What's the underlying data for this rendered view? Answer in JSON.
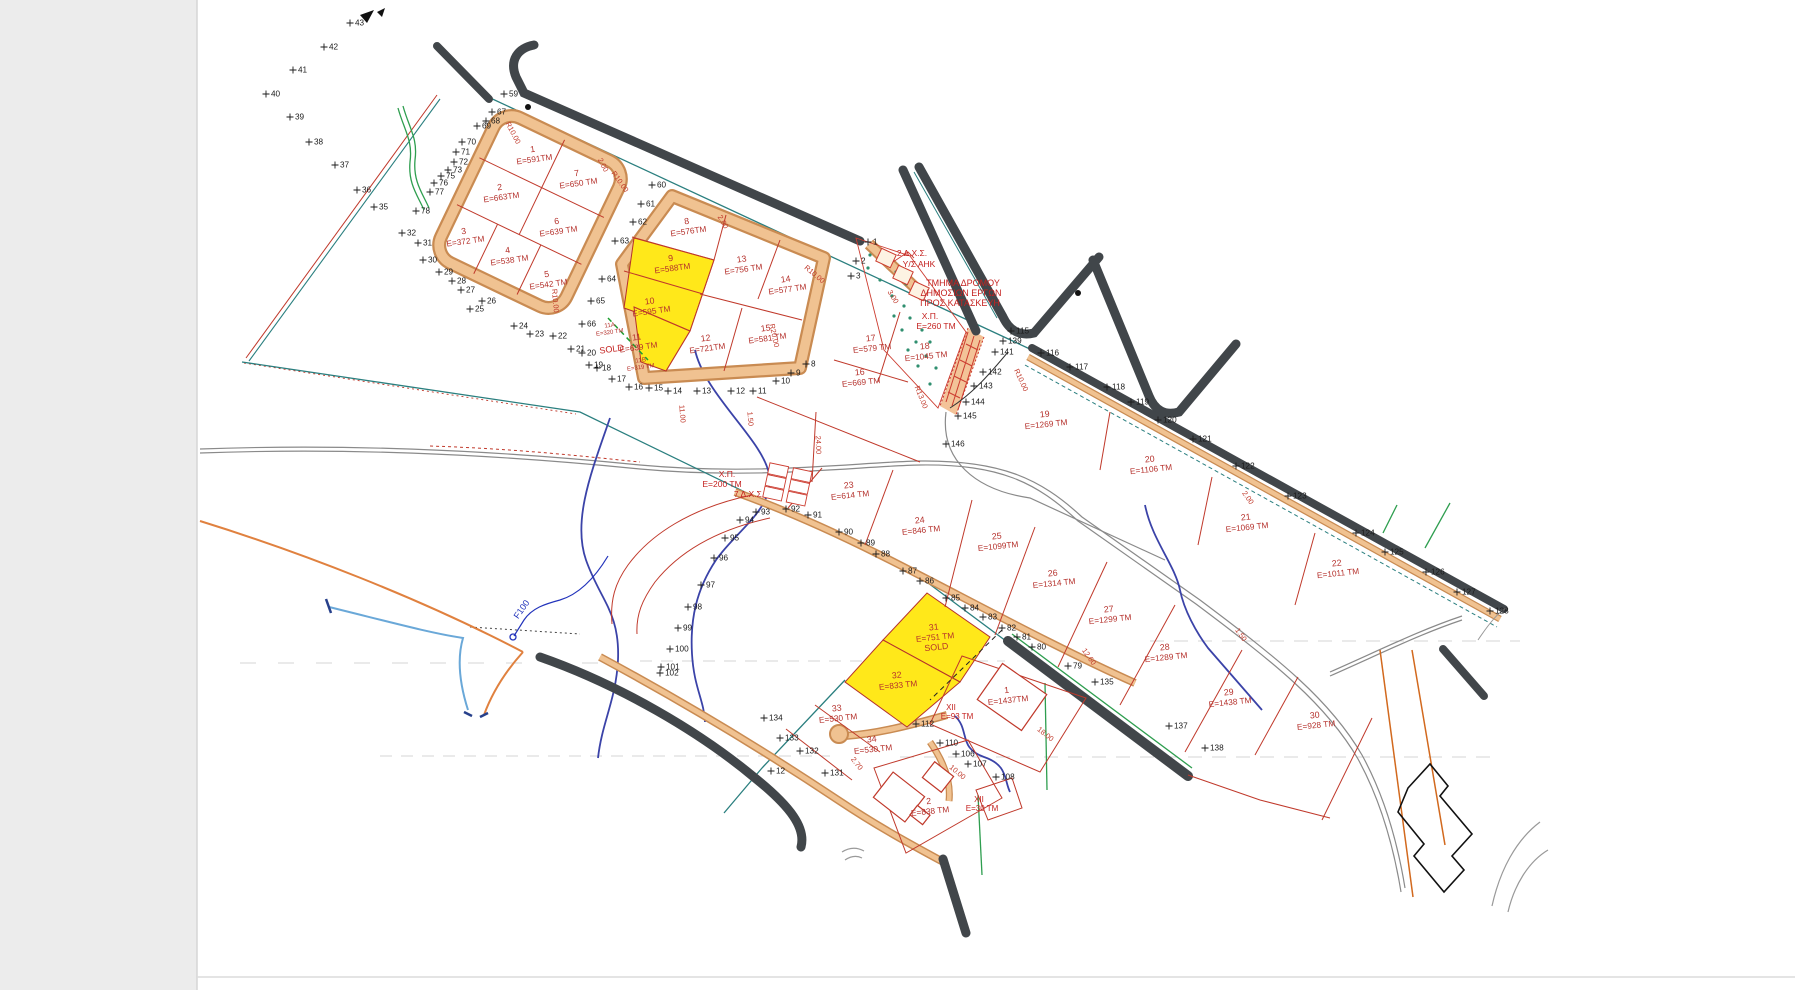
{
  "document": {
    "type_label": "cadastral subdivision plan (scanned)",
    "sold_label": "SOLD"
  },
  "colors": {
    "plot_label": "#b5312c",
    "point_label": "#1b1b1b",
    "highlight_yellow": "#ffe81a",
    "road_tan_fill": "#f0c291",
    "road_tan_edge": "#c98b52",
    "road_dark": "#41464a",
    "boundary_teal": "#2a7f7f",
    "stream_blue": "#3b43a8",
    "annotation_red": "#c42220",
    "label_blue": "#2233bb",
    "green_line": "#2e9e4f"
  },
  "plots": [
    {
      "id": "1",
      "area": "E=591TM",
      "x": 533,
      "y": 152,
      "rot": -8
    },
    {
      "id": "7",
      "area": "E=650 TM",
      "x": 577,
      "y": 176,
      "rot": -8
    },
    {
      "id": "2",
      "area": "E=663TM",
      "x": 500,
      "y": 190,
      "rot": -8
    },
    {
      "id": "6",
      "area": "E=639 TM",
      "x": 557,
      "y": 224,
      "rot": -8
    },
    {
      "id": "3",
      "area": "E=372 TM",
      "x": 464,
      "y": 234,
      "rot": -8
    },
    {
      "id": "4",
      "area": "E=538 TM",
      "x": 508,
      "y": 253,
      "rot": -8
    },
    {
      "id": "5",
      "area": "E=542 TM",
      "x": 547,
      "y": 277,
      "rot": -8
    },
    {
      "id": "8",
      "area": "E=576TM",
      "x": 687,
      "y": 224,
      "rot": -8
    },
    {
      "id": "13",
      "area": "E=756 TM",
      "x": 742,
      "y": 262,
      "rot": -8
    },
    {
      "id": "14",
      "area": "E=577 TM",
      "x": 786,
      "y": 282,
      "rot": -8
    },
    {
      "id": "9",
      "area": "E=588TM",
      "x": 671,
      "y": 261,
      "rot": -8,
      "highlight": true
    },
    {
      "id": "10",
      "area": "E=595 TM",
      "x": 650,
      "y": 304,
      "rot": -8,
      "highlight": true
    },
    {
      "id": "11",
      "area": "E=639 TM",
      "x": 637,
      "y": 340,
      "rot": -8,
      "highlight": true
    },
    {
      "id": "15",
      "area": "E=581 TM",
      "x": 766,
      "y": 331,
      "rot": -8
    },
    {
      "id": "12",
      "area": "E=721TM",
      "x": 706,
      "y": 341,
      "rot": -8
    },
    {
      "id": "17",
      "area": "E=579 TM",
      "x": 871,
      "y": 341,
      "rot": -6
    },
    {
      "id": "18",
      "area": "E=1045 TM",
      "x": 925,
      "y": 349,
      "rot": -6
    },
    {
      "id": "16",
      "area": "E=669 TM",
      "x": 860,
      "y": 375,
      "rot": -6
    },
    {
      "id": "19",
      "area": "E=1269 TM",
      "x": 1045,
      "y": 417,
      "rot": -6
    },
    {
      "id": "20",
      "area": "E=1106 TM",
      "x": 1150,
      "y": 462,
      "rot": -6
    },
    {
      "id": "21",
      "area": "E=1069 TM",
      "x": 1246,
      "y": 520,
      "rot": -6
    },
    {
      "id": "22",
      "area": "E=1011 TM",
      "x": 1337,
      "y": 566,
      "rot": -6
    },
    {
      "id": "23",
      "area": "E=614 TM",
      "x": 849,
      "y": 488,
      "rot": -6
    },
    {
      "id": "24",
      "area": "E=846 TM",
      "x": 920,
      "y": 523,
      "rot": -6
    },
    {
      "id": "25",
      "area": "E=1099TM",
      "x": 997,
      "y": 539,
      "rot": -6
    },
    {
      "id": "26",
      "area": "E=1314 TM",
      "x": 1053,
      "y": 576,
      "rot": -6
    },
    {
      "id": "27",
      "area": "E=1299 TM",
      "x": 1109,
      "y": 612,
      "rot": -6
    },
    {
      "id": "28",
      "area": "E=1289 TM",
      "x": 1165,
      "y": 650,
      "rot": -6
    },
    {
      "id": "29",
      "area": "E=1438 TM",
      "x": 1229,
      "y": 695,
      "rot": -6
    },
    {
      "id": "30",
      "area": "E=928 TM",
      "x": 1315,
      "y": 718,
      "rot": -6
    },
    {
      "id": "31",
      "area": "E=751 TM",
      "x": 934,
      "y": 630,
      "rot": -6,
      "highlight": true,
      "line3": "SOLD"
    },
    {
      "id": "32",
      "area": "E=833 TM",
      "x": 897,
      "y": 678,
      "rot": -6,
      "highlight": true
    },
    {
      "id": "33",
      "area": "E=530 TM",
      "x": 837,
      "y": 711,
      "rot": -6
    },
    {
      "id": "34",
      "area": "E=530 TM",
      "x": 872,
      "y": 742,
      "rot": -6
    },
    {
      "id": "1",
      "area": "E=1437TM",
      "x": 1007,
      "y": 693,
      "rot": -6
    },
    {
      "id": "2",
      "area": "E=838 TM",
      "x": 929,
      "y": 804,
      "rot": -6
    }
  ],
  "sub_plots": [
    {
      "id": "11A",
      "area": "E=320 TM",
      "x": 610,
      "y": 327,
      "rot": -8
    },
    {
      "id": "11B",
      "area": "E=319 TM",
      "x": 641,
      "y": 362,
      "rot": -8
    }
  ],
  "annotations": [
    {
      "slug": "tmima-1",
      "text": "ΤΜΗΜΑ ΔΡΟΜΟΥ",
      "x": 963,
      "y": 286,
      "rot": 0,
      "color": "#c42220",
      "size": 9
    },
    {
      "slug": "tmima-2",
      "text": "ΔΗΜΟΣΙΩΝ ΕΡΓΩΝ",
      "x": 961,
      "y": 296,
      "rot": 0,
      "color": "#c42220",
      "size": 9
    },
    {
      "slug": "tmima-3",
      "text": "ΠΡΟΣ ΚΑΤΑΣΚΕΥΗ",
      "x": 960,
      "y": 306,
      "rot": 0,
      "color": "#c42220",
      "size": 9
    },
    {
      "slug": "dxs2-1",
      "text": "2 Δ.Χ.Σ.",
      "x": 912,
      "y": 256,
      "rot": 0,
      "color": "#c42220",
      "size": 8.5
    },
    {
      "slug": "dxs2-2",
      "text": "Υ/Σ ΑΗΚ",
      "x": 919,
      "y": 267,
      "rot": 0,
      "color": "#c42220",
      "size": 8.5
    },
    {
      "slug": "xp260-1",
      "text": "Χ.Π.",
      "x": 930,
      "y": 319,
      "rot": 0,
      "color": "#c42220",
      "size": 8.5
    },
    {
      "slug": "xp260-2",
      "text": "Ε=260 ΤΜ",
      "x": 936,
      "y": 329,
      "rot": 0,
      "color": "#c42220",
      "size": 8.5
    },
    {
      "slug": "xp200-1",
      "text": "Χ.Π.",
      "x": 727,
      "y": 477,
      "rot": 0,
      "color": "#c42220",
      "size": 8.5
    },
    {
      "slug": "xp200-2",
      "text": "Ε=200 ΤΜ",
      "x": 722,
      "y": 487,
      "rot": 0,
      "color": "#c42220",
      "size": 8.5
    },
    {
      "slug": "dxs7",
      "text": "7 Δ.Χ.Σ.",
      "x": 749,
      "y": 497,
      "rot": 0,
      "color": "#c42220",
      "size": 8.5
    },
    {
      "slug": "xii93-1",
      "text": "ΧΙΙ",
      "x": 951,
      "y": 710,
      "rot": 0,
      "color": "#c42220",
      "size": 8
    },
    {
      "slug": "xii93-2",
      "text": "Ε=93 ΤΜ",
      "x": 957,
      "y": 719,
      "rot": 0,
      "color": "#c42220",
      "size": 8
    },
    {
      "slug": "xii30-1",
      "text": "ΧΙΙ",
      "x": 979,
      "y": 802,
      "rot": 0,
      "color": "#c42220",
      "size": 8
    },
    {
      "slug": "xii30-2",
      "text": "Ε=30 ΤΜ",
      "x": 982,
      "y": 811,
      "rot": 0,
      "color": "#c42220",
      "size": 8
    },
    {
      "slug": "sold-11",
      "text": "SOLD",
      "x": 612,
      "y": 352,
      "rot": -8,
      "color": "#c42220",
      "size": 9
    },
    {
      "slug": "f100",
      "text": "F100",
      "x": 524,
      "y": 611,
      "rot": -55,
      "color": "#2233bb",
      "size": 9
    }
  ],
  "dimensions": [
    {
      "t": "R10.00",
      "x": 511,
      "y": 134,
      "r": 62
    },
    {
      "t": "R10.00",
      "x": 618,
      "y": 183,
      "r": 55
    },
    {
      "t": "R10.00",
      "x": 553,
      "y": 301,
      "r": 85
    },
    {
      "t": "R10.00",
      "x": 813,
      "y": 276,
      "r": 40
    },
    {
      "t": "R10.00",
      "x": 1019,
      "y": 381,
      "r": 65
    },
    {
      "t": "R13.00",
      "x": 919,
      "y": 398,
      "r": 68
    },
    {
      "t": "R20.00",
      "x": 772,
      "y": 336,
      "r": 78
    },
    {
      "t": "2.00",
      "x": 601,
      "y": 166,
      "r": 62
    },
    {
      "t": "2.00",
      "x": 721,
      "y": 223,
      "r": 60
    },
    {
      "t": "2.00",
      "x": 1246,
      "y": 499,
      "r": 55
    },
    {
      "t": "3.00",
      "x": 891,
      "y": 298,
      "r": 58
    },
    {
      "t": "24.00",
      "x": 816,
      "y": 445,
      "r": 88
    },
    {
      "t": "12.60",
      "x": 1087,
      "y": 658,
      "r": 55
    },
    {
      "t": "1.50",
      "x": 1239,
      "y": 636,
      "r": 55
    },
    {
      "t": "2.70",
      "x": 855,
      "y": 765,
      "r": 52
    },
    {
      "t": "10.00",
      "x": 956,
      "y": 774,
      "r": 40
    },
    {
      "t": "11.00",
      "x": 680,
      "y": 414,
      "r": 85
    },
    {
      "t": "1.50",
      "x": 748,
      "y": 419,
      "r": 85
    },
    {
      "t": "18.00",
      "x": 1044,
      "y": 736,
      "r": 38
    }
  ],
  "survey_points": [
    {
      "n": "35",
      "x": 374,
      "y": 207
    },
    {
      "n": "36",
      "x": 357,
      "y": 190
    },
    {
      "n": "37",
      "x": 335,
      "y": 165
    },
    {
      "n": "38",
      "x": 309,
      "y": 142
    },
    {
      "n": "39",
      "x": 290,
      "y": 117
    },
    {
      "n": "40",
      "x": 266,
      "y": 94
    },
    {
      "n": "41",
      "x": 293,
      "y": 70
    },
    {
      "n": "42",
      "x": 324,
      "y": 47
    },
    {
      "n": "43",
      "x": 350,
      "y": 23
    },
    {
      "n": "59",
      "x": 504,
      "y": 94
    },
    {
      "n": "60",
      "x": 652,
      "y": 185
    },
    {
      "n": "61",
      "x": 641,
      "y": 204
    },
    {
      "n": "62",
      "x": 633,
      "y": 222
    },
    {
      "n": "63",
      "x": 615,
      "y": 241
    },
    {
      "n": "64",
      "x": 602,
      "y": 279
    },
    {
      "n": "65",
      "x": 591,
      "y": 301
    },
    {
      "n": "66",
      "x": 582,
      "y": 324
    },
    {
      "n": "67",
      "x": 492,
      "y": 112
    },
    {
      "n": "68",
      "x": 486,
      "y": 121
    },
    {
      "n": "69",
      "x": 477,
      "y": 126
    },
    {
      "n": "70",
      "x": 462,
      "y": 142
    },
    {
      "n": "71",
      "x": 456,
      "y": 152
    },
    {
      "n": "72",
      "x": 454,
      "y": 162
    },
    {
      "n": "73",
      "x": 448,
      "y": 170
    },
    {
      "n": "75",
      "x": 441,
      "y": 176
    },
    {
      "n": "76",
      "x": 434,
      "y": 183
    },
    {
      "n": "77",
      "x": 430,
      "y": 192
    },
    {
      "n": "78",
      "x": 416,
      "y": 211
    },
    {
      "n": "32",
      "x": 402,
      "y": 233
    },
    {
      "n": "31",
      "x": 418,
      "y": 243
    },
    {
      "n": "30",
      "x": 423,
      "y": 260
    },
    {
      "n": "29",
      "x": 439,
      "y": 272
    },
    {
      "n": "28",
      "x": 452,
      "y": 281
    },
    {
      "n": "27",
      "x": 461,
      "y": 290
    },
    {
      "n": "26",
      "x": 482,
      "y": 301
    },
    {
      "n": "25",
      "x": 470,
      "y": 309
    },
    {
      "n": "24",
      "x": 514,
      "y": 326
    },
    {
      "n": "23",
      "x": 530,
      "y": 334
    },
    {
      "n": "22",
      "x": 553,
      "y": 336
    },
    {
      "n": "21",
      "x": 571,
      "y": 349
    },
    {
      "n": "20",
      "x": 582,
      "y": 353
    },
    {
      "n": "19",
      "x": 589,
      "y": 365
    },
    {
      "n": "18",
      "x": 597,
      "y": 368
    },
    {
      "n": "17",
      "x": 612,
      "y": 379
    },
    {
      "n": "16",
      "x": 629,
      "y": 387
    },
    {
      "n": "15",
      "x": 649,
      "y": 388
    },
    {
      "n": "14",
      "x": 668,
      "y": 391
    },
    {
      "n": "13",
      "x": 697,
      "y": 391
    },
    {
      "n": "12",
      "x": 731,
      "y": 391
    },
    {
      "n": "11",
      "x": 753,
      "y": 391
    },
    {
      "n": "10",
      "x": 776,
      "y": 381
    },
    {
      "n": "9",
      "x": 791,
      "y": 373
    },
    {
      "n": "8",
      "x": 806,
      "y": 364
    },
    {
      "n": "1",
      "x": 868,
      "y": 242
    },
    {
      "n": "2",
      "x": 856,
      "y": 261
    },
    {
      "n": "3",
      "x": 851,
      "y": 276
    },
    {
      "n": "115",
      "x": 1011,
      "y": 331
    },
    {
      "n": "139",
      "x": 1003,
      "y": 341
    },
    {
      "n": "141",
      "x": 995,
      "y": 352
    },
    {
      "n": "142",
      "x": 983,
      "y": 372
    },
    {
      "n": "143",
      "x": 974,
      "y": 386
    },
    {
      "n": "144",
      "x": 966,
      "y": 402
    },
    {
      "n": "145",
      "x": 958,
      "y": 416
    },
    {
      "n": "146",
      "x": 946,
      "y": 444
    },
    {
      "n": "116",
      "x": 1041,
      "y": 353
    },
    {
      "n": "117",
      "x": 1070,
      "y": 367
    },
    {
      "n": "118",
      "x": 1107,
      "y": 387
    },
    {
      "n": "119",
      "x": 1131,
      "y": 402
    },
    {
      "n": "120",
      "x": 1158,
      "y": 420
    },
    {
      "n": "121",
      "x": 1193,
      "y": 439
    },
    {
      "n": "122",
      "x": 1236,
      "y": 466
    },
    {
      "n": "123",
      "x": 1288,
      "y": 496
    },
    {
      "n": "124",
      "x": 1356,
      "y": 533
    },
    {
      "n": "125",
      "x": 1385,
      "y": 552
    },
    {
      "n": "126",
      "x": 1426,
      "y": 572
    },
    {
      "n": "127",
      "x": 1457,
      "y": 592
    },
    {
      "n": "128",
      "x": 1490,
      "y": 611
    },
    {
      "n": "79",
      "x": 1068,
      "y": 666
    },
    {
      "n": "80",
      "x": 1032,
      "y": 647
    },
    {
      "n": "81",
      "x": 1017,
      "y": 637
    },
    {
      "n": "82",
      "x": 1002,
      "y": 628
    },
    {
      "n": "83",
      "x": 983,
      "y": 617
    },
    {
      "n": "84",
      "x": 965,
      "y": 608
    },
    {
      "n": "85",
      "x": 946,
      "y": 598
    },
    {
      "n": "86",
      "x": 920,
      "y": 581
    },
    {
      "n": "87",
      "x": 903,
      "y": 571
    },
    {
      "n": "88",
      "x": 876,
      "y": 554
    },
    {
      "n": "89",
      "x": 861,
      "y": 543
    },
    {
      "n": "90",
      "x": 839,
      "y": 532
    },
    {
      "n": "91",
      "x": 808,
      "y": 515
    },
    {
      "n": "92",
      "x": 786,
      "y": 509
    },
    {
      "n": "93",
      "x": 756,
      "y": 512
    },
    {
      "n": "94",
      "x": 740,
      "y": 520
    },
    {
      "n": "95",
      "x": 725,
      "y": 538
    },
    {
      "n": "96",
      "x": 714,
      "y": 558
    },
    {
      "n": "97",
      "x": 701,
      "y": 585
    },
    {
      "n": "98",
      "x": 688,
      "y": 607
    },
    {
      "n": "99",
      "x": 678,
      "y": 628
    },
    {
      "n": "100",
      "x": 670,
      "y": 649
    },
    {
      "n": "101",
      "x": 661,
      "y": 667
    },
    {
      "n": "102",
      "x": 660,
      "y": 673
    },
    {
      "n": "110",
      "x": 940,
      "y": 743
    },
    {
      "n": "106",
      "x": 956,
      "y": 754
    },
    {
      "n": "107",
      "x": 968,
      "y": 764
    },
    {
      "n": "108",
      "x": 996,
      "y": 777
    },
    {
      "n": "112",
      "x": 916,
      "y": 724
    },
    {
      "n": "131",
      "x": 825,
      "y": 773
    },
    {
      "n": "132",
      "x": 800,
      "y": 751
    },
    {
      "n": "133",
      "x": 780,
      "y": 738
    },
    {
      "n": "134",
      "x": 764,
      "y": 718
    },
    {
      "n": "135",
      "x": 1095,
      "y": 682
    },
    {
      "n": "137",
      "x": 1169,
      "y": 726
    },
    {
      "n": "138",
      "x": 1205,
      "y": 748
    },
    {
      "n": "12",
      "x": 771,
      "y": 771
    }
  ]
}
